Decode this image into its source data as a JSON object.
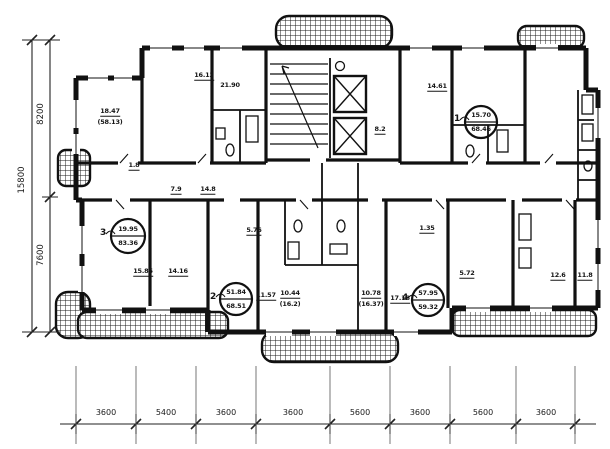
{
  "plan": {
    "dims": {
      "left_total": "15800",
      "left_upper": "8200",
      "left_lower": "7600",
      "bottom": [
        "3600",
        "5400",
        "3600",
        "3600",
        "5600",
        "3600",
        "5600",
        "3600"
      ]
    },
    "apartments": [
      {
        "num": "1",
        "top": "15.70",
        "bot": "68.46"
      },
      {
        "num": "2",
        "top": "51.84",
        "bot": "68.51"
      },
      {
        "num": "3",
        "top": "19.95",
        "bot": "83.36"
      },
      {
        "num": "4",
        "top": "57.95",
        "bot": "59.32"
      }
    ],
    "rooms": [
      {
        "t": "18.47"
      },
      {
        "t": "(58.13)"
      },
      {
        "t": "16.13"
      },
      {
        "t": "21.90"
      },
      {
        "t": "14.61"
      },
      {
        "t": "8.2"
      },
      {
        "t": "1.8"
      },
      {
        "t": "7.9"
      },
      {
        "t": "14.8"
      },
      {
        "t": "5.76"
      },
      {
        "t": "1.35"
      },
      {
        "t": "15.85"
      },
      {
        "t": "14.16"
      },
      {
        "t": "11.57"
      },
      {
        "t": "10.44"
      },
      {
        "t": "(16.2)"
      },
      {
        "t": "10.78"
      },
      {
        "t": "(16.37)"
      },
      {
        "t": "17.18"
      },
      {
        "t": "5.72"
      },
      {
        "t": "12.6"
      },
      {
        "t": "11.8"
      }
    ]
  }
}
